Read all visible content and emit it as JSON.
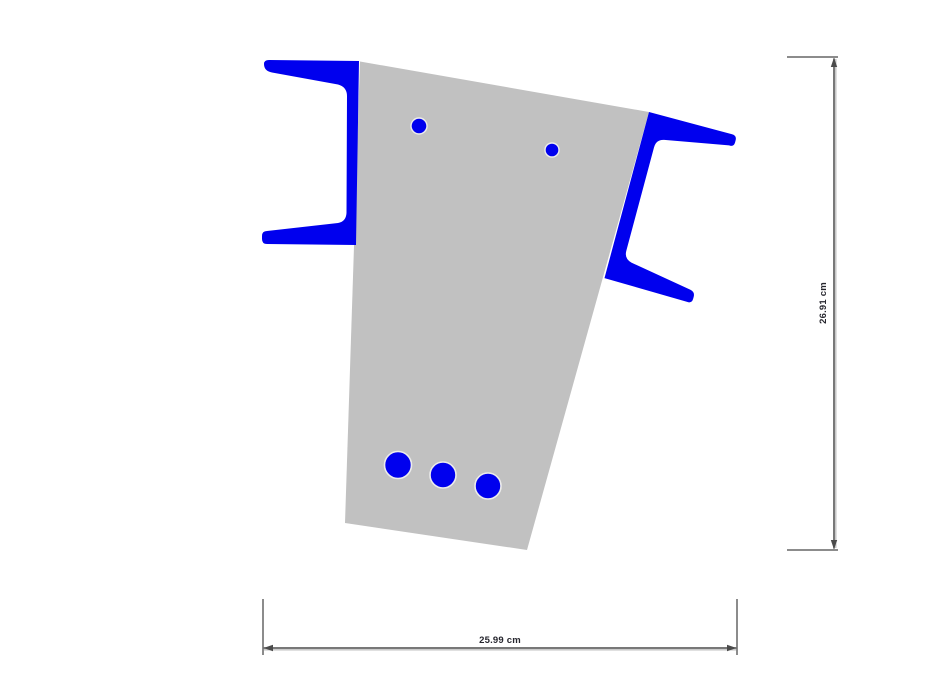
{
  "palette": {
    "background": "#ffffff",
    "concrete": "#c1c1c1",
    "steel": "#0000ee",
    "hole_outline": "#ececec",
    "dim_line": "#4b4b4b",
    "dim_line_shadow": "#c2c2c2",
    "extension_line": "#8c8c8c",
    "dim_text": "#26262e"
  },
  "dimensions": {
    "height_label": "26.91 cm",
    "width_label": "25.99 cm"
  }
}
